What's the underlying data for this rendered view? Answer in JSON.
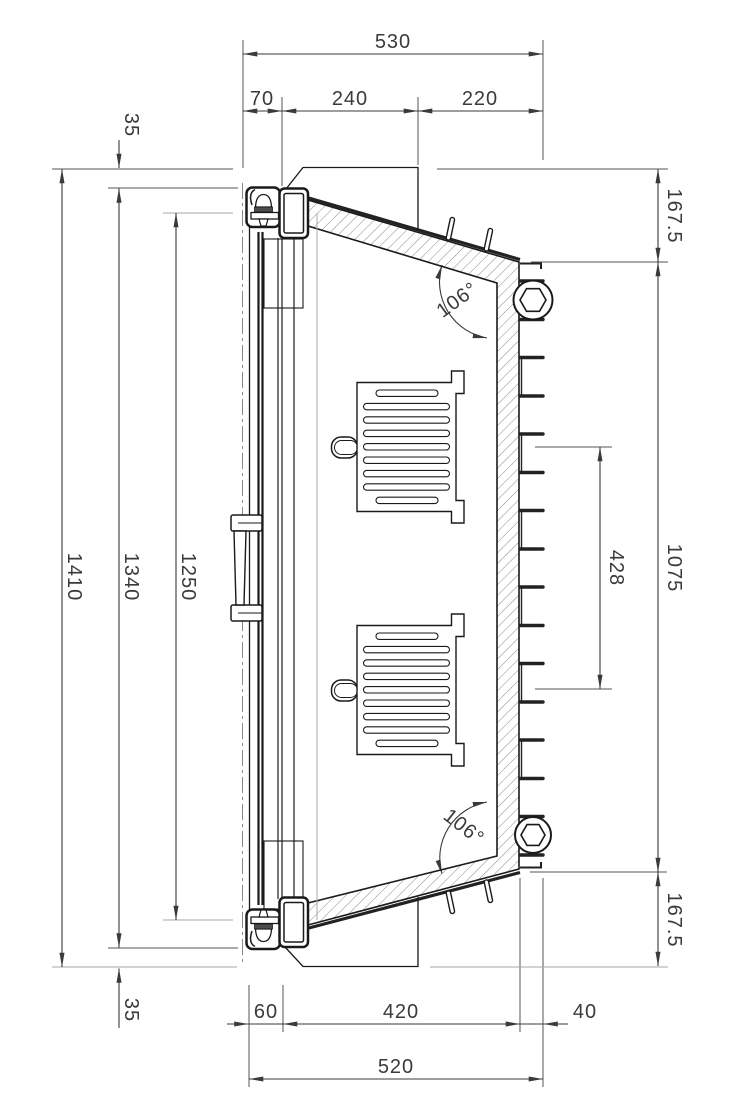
{
  "document": {
    "type": "CAD technical drawing",
    "view": "vertical cross-section of wall-mounted enclosure with door",
    "units_implied": "mm"
  },
  "colors": {
    "ink": "#3a3a3a",
    "geometry": "#1a1a1a",
    "reference_lines": "#a5a5a5",
    "hatch": "#8a8a8a",
    "background": "#ffffff"
  },
  "dimensions": {
    "top": {
      "total": "530",
      "seg1": "70",
      "seg2": "240",
      "seg3": "220"
    },
    "left": {
      "offset_top": "35",
      "outer_height": "1410",
      "frame_height": "1340",
      "opening_height": "1250",
      "offset_bottom": "35"
    },
    "right": {
      "top_offset": "167.5",
      "wall_height": "1075",
      "bottom_offset": "167.5",
      "clip_span": "428"
    },
    "angles": {
      "top": "106°",
      "bottom": "106°"
    },
    "bottom": {
      "seg1": "60",
      "seg2": "420",
      "seg3": "40",
      "total": "520"
    }
  }
}
